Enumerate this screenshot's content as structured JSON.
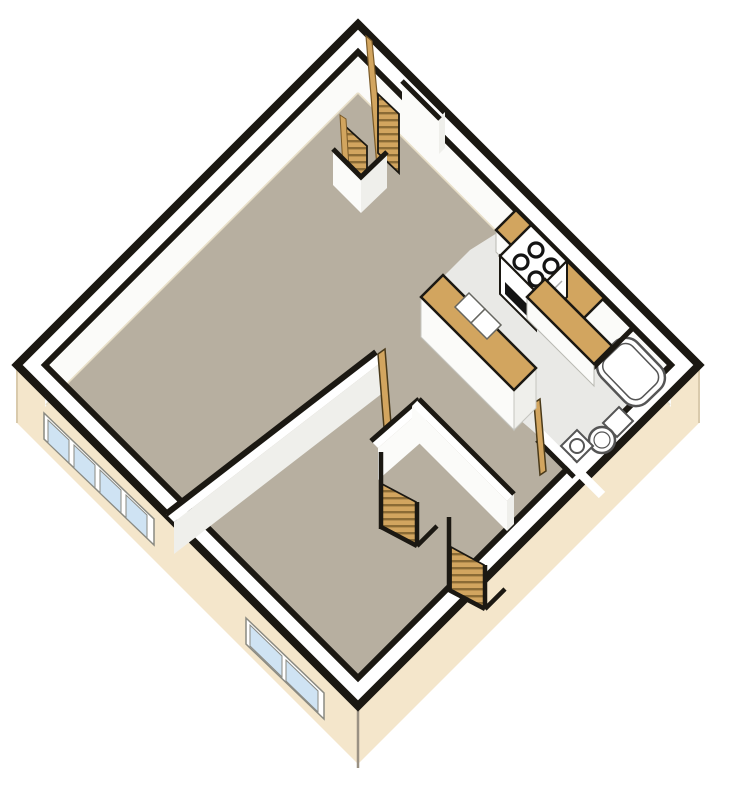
{
  "meta": {
    "type": "isometric-3d-floor-plan",
    "description": "One-bedroom apartment unit shown as a diamond-oriented isometric cutaway floor plan with living room, kitchen, bathroom, bedroom and two stairways"
  },
  "colors": {
    "background": "#ffffff",
    "outline": "#1b1812",
    "wall_top": "#ffffff",
    "wall_face": "#fbfbf9",
    "wall_face_shaded": "#efefeb",
    "exterior_face": "#f4e6cb",
    "exterior_edge": "#d9caac",
    "floor_main": "#b7afa0",
    "floor_wet": "#e9e9e6",
    "wood": "#d2a55f",
    "wood_dark": "#8b6b35",
    "window_glass": "#cfe3f3",
    "window_frame": "#ffffff",
    "fixture_outline": "#555555",
    "appliance_black": "#141414",
    "floor_edge_tint": "#e8dfc8"
  },
  "rooms": {
    "living_room": "living room (upper left, tan floor)",
    "bedroom": "bedroom (lower center, tan floor)",
    "kitchen": "kitchen (upper right, gray floor)",
    "bathroom": "bathroom (right corner, gray floor)"
  },
  "fixtures": {
    "upper_stairs_flights": 2,
    "lower_stairs_flights": 2,
    "stove_burners": 4,
    "kitchen_sink_basins": 2,
    "window_left_panes": 4,
    "window_bottom_panes": 2,
    "doors_open": 2,
    "bathroom_items": [
      "bathtub",
      "toilet",
      "vanity-sink"
    ]
  }
}
